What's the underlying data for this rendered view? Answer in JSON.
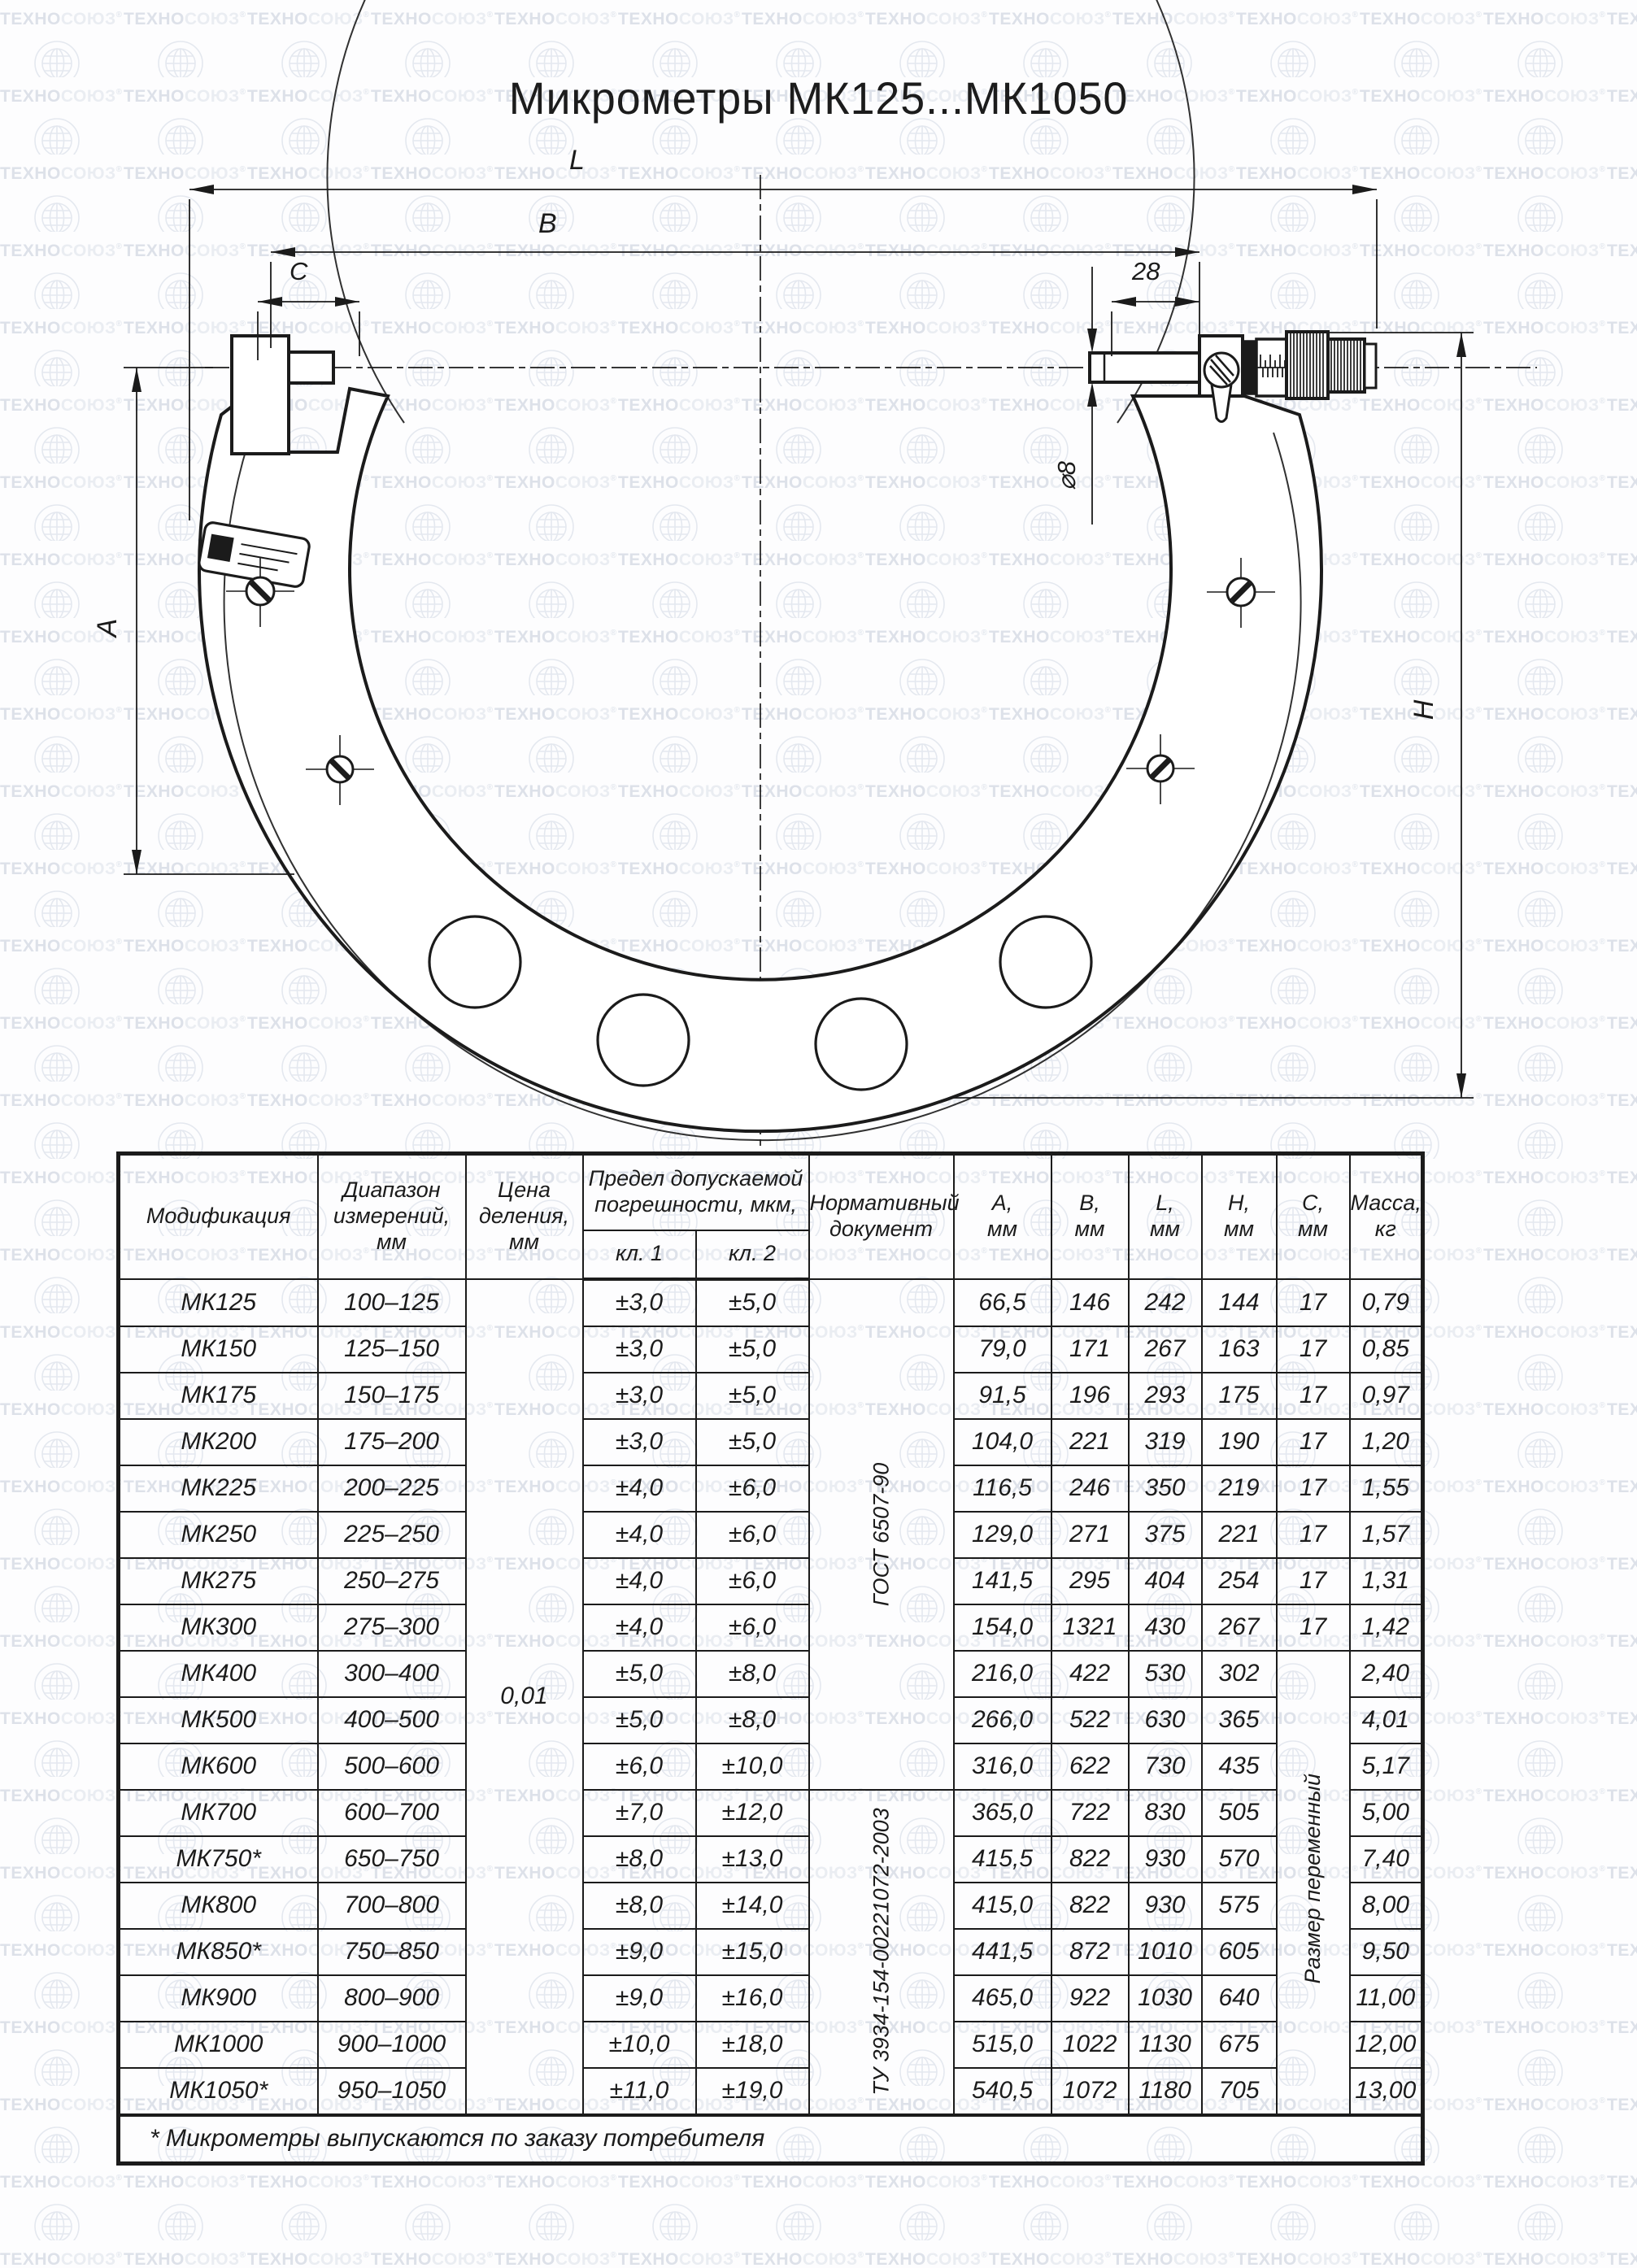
{
  "watermark": {
    "text_dark": "ТЕХНО",
    "text_light": "СОЮЗ",
    "reg": "®"
  },
  "title": "Микрометры МК125...МК1050",
  "drawing": {
    "labels": {
      "L": "L",
      "B": "B",
      "C": "C",
      "dim28": "28",
      "dia8": "⌀8",
      "A": "A",
      "H": "H"
    }
  },
  "table": {
    "headers": {
      "mod": "Модификация",
      "range": "Диапазон\nизмерений,\nмм",
      "division": "Цена\nделения,\nмм",
      "tolerance": "Предел допускаемой\nпогрешности, мкм,",
      "kl1": "кл. 1",
      "kl2": "кл. 2",
      "doc": "Нормативный\nдокумент",
      "a": "А,\nмм",
      "b": "В,\nмм",
      "l": "L,\nмм",
      "h": "Н,\nмм",
      "c": "С,\nмм",
      "mass": "Масса,\nкг"
    },
    "merged": {
      "division_value": "0,01",
      "doc_gost": "ГОСТ 6507-90",
      "doc_tu": "ТУ 3934-154-00221072-2003",
      "c_note": "Размер переменный"
    },
    "rows": [
      {
        "mod": "МК125",
        "range": "100–125",
        "kl1": "±3,0",
        "kl2": "±5,0",
        "a": "66,5",
        "b": "146",
        "l": "242",
        "h": "144",
        "c": "17",
        "m": "0,79"
      },
      {
        "mod": "МК150",
        "range": "125–150",
        "kl1": "±3,0",
        "kl2": "±5,0",
        "a": "79,0",
        "b": "171",
        "l": "267",
        "h": "163",
        "c": "17",
        "m": "0,85"
      },
      {
        "mod": "МК175",
        "range": "150–175",
        "kl1": "±3,0",
        "kl2": "±5,0",
        "a": "91,5",
        "b": "196",
        "l": "293",
        "h": "175",
        "c": "17",
        "m": "0,97"
      },
      {
        "mod": "МК200",
        "range": "175–200",
        "kl1": "±3,0",
        "kl2": "±5,0",
        "a": "104,0",
        "b": "221",
        "l": "319",
        "h": "190",
        "c": "17",
        "m": "1,20"
      },
      {
        "mod": "МК225",
        "range": "200–225",
        "kl1": "±4,0",
        "kl2": "±6,0",
        "a": "116,5",
        "b": "246",
        "l": "350",
        "h": "219",
        "c": "17",
        "m": "1,55"
      },
      {
        "mod": "МК250",
        "range": "225–250",
        "kl1": "±4,0",
        "kl2": "±6,0",
        "a": "129,0",
        "b": "271",
        "l": "375",
        "h": "221",
        "c": "17",
        "m": "1,57"
      },
      {
        "mod": "МК275",
        "range": "250–275",
        "kl1": "±4,0",
        "kl2": "±6,0",
        "a": "141,5",
        "b": "295",
        "l": "404",
        "h": "254",
        "c": "17",
        "m": "1,31"
      },
      {
        "mod": "МК300",
        "range": "275–300",
        "kl1": "±4,0",
        "kl2": "±6,0",
        "a": "154,0",
        "b": "1321",
        "l": "430",
        "h": "267",
        "c": "17",
        "m": "1,42"
      },
      {
        "mod": "МК400",
        "range": "300–400",
        "kl1": "±5,0",
        "kl2": "±8,0",
        "a": "216,0",
        "b": "422",
        "l": "530",
        "h": "302",
        "c": "",
        "m": "2,40"
      },
      {
        "mod": "МК500",
        "range": "400–500",
        "kl1": "±5,0",
        "kl2": "±8,0",
        "a": "266,0",
        "b": "522",
        "l": "630",
        "h": "365",
        "c": "",
        "m": "4,01"
      },
      {
        "mod": "МК600",
        "range": "500–600",
        "kl1": "±6,0",
        "kl2": "±10,0",
        "a": "316,0",
        "b": "622",
        "l": "730",
        "h": "435",
        "c": "",
        "m": "5,17"
      },
      {
        "mod": "МК700",
        "range": "600–700",
        "kl1": "±7,0",
        "kl2": "±12,0",
        "a": "365,0",
        "b": "722",
        "l": "830",
        "h": "505",
        "c": "",
        "m": "5,00"
      },
      {
        "mod": "МК750*",
        "range": "650–750",
        "kl1": "±8,0",
        "kl2": "±13,0",
        "a": "415,5",
        "b": "822",
        "l": "930",
        "h": "570",
        "c": "",
        "m": "7,40"
      },
      {
        "mod": "МК800",
        "range": "700–800",
        "kl1": "±8,0",
        "kl2": "±14,0",
        "a": "415,0",
        "b": "822",
        "l": "930",
        "h": "575",
        "c": "",
        "m": "8,00"
      },
      {
        "mod": "МК850*",
        "range": "750–850",
        "kl1": "±9,0",
        "kl2": "±15,0",
        "a": "441,5",
        "b": "872",
        "l": "1010",
        "h": "605",
        "c": "",
        "m": "9,50"
      },
      {
        "mod": "МК900",
        "range": "800–900",
        "kl1": "±9,0",
        "kl2": "±16,0",
        "a": "465,0",
        "b": "922",
        "l": "1030",
        "h": "640",
        "c": "",
        "m": "11,00"
      },
      {
        "mod": "МК1000",
        "range": "900–1000",
        "kl1": "±10,0",
        "kl2": "±18,0",
        "a": "515,0",
        "b": "1022",
        "l": "1130",
        "h": "675",
        "c": "",
        "m": "12,00"
      },
      {
        "mod": "МК1050*",
        "range": "950–1050",
        "kl1": "±11,0",
        "kl2": "±19,0",
        "a": "540,5",
        "b": "1072",
        "l": "1180",
        "h": "705",
        "c": "",
        "m": "13,00"
      }
    ],
    "footnote": "* Микрометры выпускаются по заказу потребителя"
  }
}
